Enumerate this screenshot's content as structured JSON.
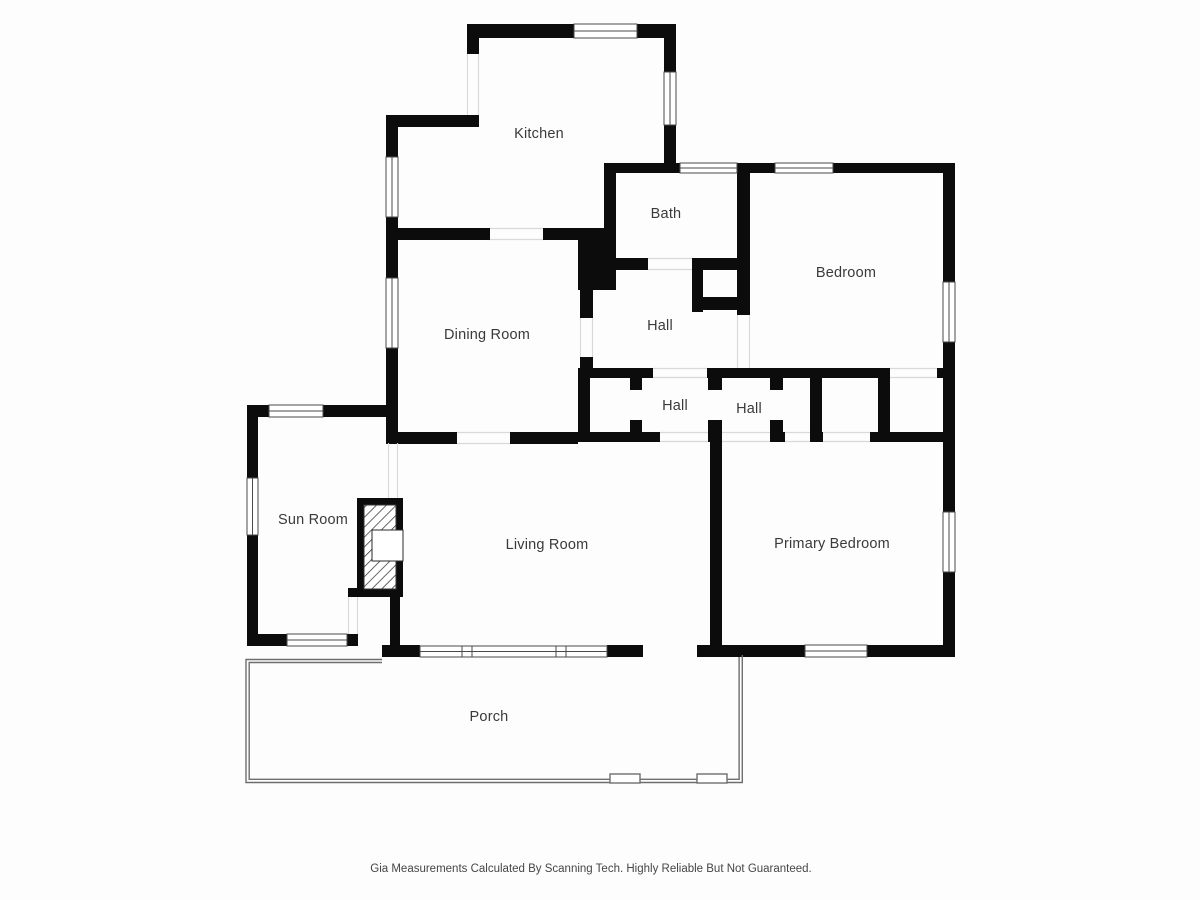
{
  "floorplan": {
    "rooms": {
      "kitchen": {
        "label": "Kitchen"
      },
      "bath": {
        "label": "Bath"
      },
      "bedroom": {
        "label": "Bedroom"
      },
      "dining_room": {
        "label": "Dining Room"
      },
      "hall_upper": {
        "label": "Hall"
      },
      "hall_west": {
        "label": "Hall"
      },
      "hall_center": {
        "label": "Hall"
      },
      "sun_room": {
        "label": "Sun Room"
      },
      "living_room": {
        "label": "Living Room"
      },
      "primary_bedroom": {
        "label": "Primary Bedroom"
      },
      "porch": {
        "label": "Porch"
      }
    },
    "footer": {
      "disclaimer": "Gia Measurements Calculated By Scanning Tech. Highly Reliable But Not Guaranteed."
    },
    "colors": {
      "wall": "#0c0c0c",
      "window_outline": "#4a4a4a",
      "opening_line": "#d9d9d9",
      "porch_line": "#6e6e6e",
      "hatch_line": "#333333",
      "label_text": "#3a3a3a",
      "background": "#fdfdfd"
    }
  }
}
